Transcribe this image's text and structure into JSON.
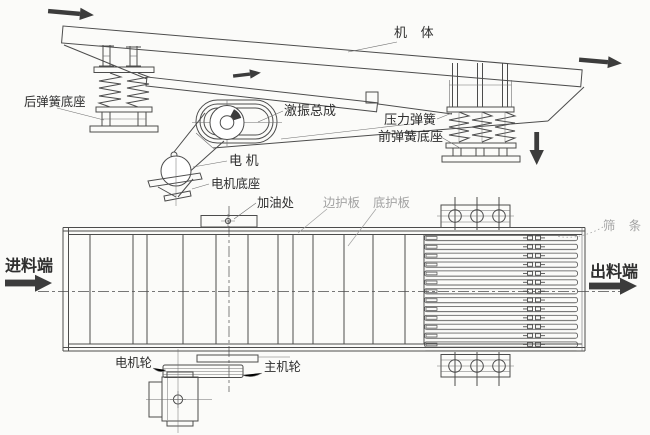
{
  "colors": {
    "paper": "#fbfbf9",
    "line": "#4c4c4c",
    "line-light": "#6e6e6e",
    "label": "#2e2e2e",
    "label-gray": "#a2a2a2",
    "arrow": "#3c3c3c"
  },
  "labels": {
    "side_view": {
      "machine_body": "机 体",
      "rear_spring_base": "后弹簧底座",
      "exciter_assembly": "激振总成",
      "pressure_spring": "压力弹簧",
      "front_spring_base": "前弹簧底座",
      "motor": "电 机",
      "motor_base": "电机底座"
    },
    "plan_view": {
      "oil_fill": "加油处",
      "side_guard_plate": "边护板",
      "bottom_guard_plate": "底护板",
      "screen_bars": "筛 条",
      "feed_end": "进料端",
      "discharge_end": "出料端",
      "motor_wheel": "电机轮",
      "main_wheel": "主机轮"
    }
  }
}
